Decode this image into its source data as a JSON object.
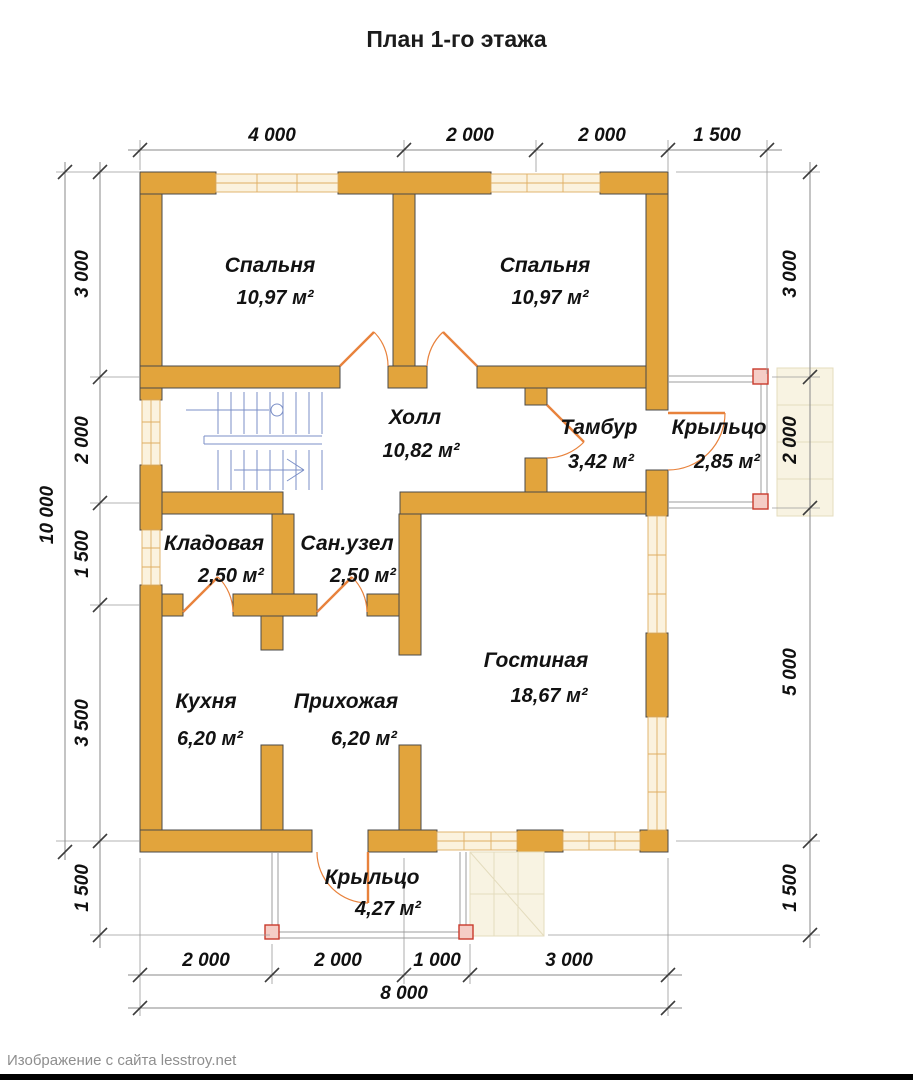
{
  "title": "План 1-го этажа",
  "watermark": "Изображение с сайта lesstroy.net",
  "rooms": [
    {
      "id": "bedroom-left",
      "name": "Спальня",
      "area": "10,97 м²"
    },
    {
      "id": "bedroom-right",
      "name": "Спальня",
      "area": "10,97 м²"
    },
    {
      "id": "hall",
      "name": "Холл",
      "area": "10,82 м²"
    },
    {
      "id": "tambour",
      "name": "Тамбур",
      "area": "3,42 м²"
    },
    {
      "id": "porch-right",
      "name": "Крыльцо",
      "area": "2,85 м²"
    },
    {
      "id": "storage",
      "name": "Кладовая",
      "area": "2,50 м²"
    },
    {
      "id": "bathroom",
      "name": "Сан.узел",
      "area": "2,50 м²"
    },
    {
      "id": "kitchen",
      "name": "Кухня",
      "area": "6,20 м²"
    },
    {
      "id": "entry",
      "name": "Прихожая",
      "area": "6,20 м²"
    },
    {
      "id": "living",
      "name": "Гостиная",
      "area": "18,67 м²"
    },
    {
      "id": "porch-bottom",
      "name": "Крыльцо",
      "area": "4,27 м²"
    }
  ],
  "dimensions": {
    "top": [
      "4 000",
      "2 000",
      "2 000",
      "1 500"
    ],
    "left": [
      "3 000",
      "2 000",
      "1 500",
      "3 500",
      "1 500"
    ],
    "left_total": "10 000",
    "right": [
      "3 000",
      "2 000",
      "5 000",
      "1 500"
    ],
    "bottom": [
      "2 000",
      "2 000",
      "1 000",
      "3 000"
    ],
    "bottom_total": "8 000"
  },
  "colors": {
    "wall": "#E2A43C",
    "wall_outline": "#4A4A4A",
    "window_fill": "#FBF2DE",
    "window_line": "#DFAE62",
    "door": "#E8823C",
    "stairs": "#7B8FC7",
    "dimension_line": "#8A8A8A",
    "text": "#121212",
    "porch_line": "#9C9C9C",
    "post_stroke": "#C93A2C",
    "post_fill": "#F5CDC6",
    "steps_fill": "#F8F3E2",
    "footer_bar": "#000000"
  }
}
